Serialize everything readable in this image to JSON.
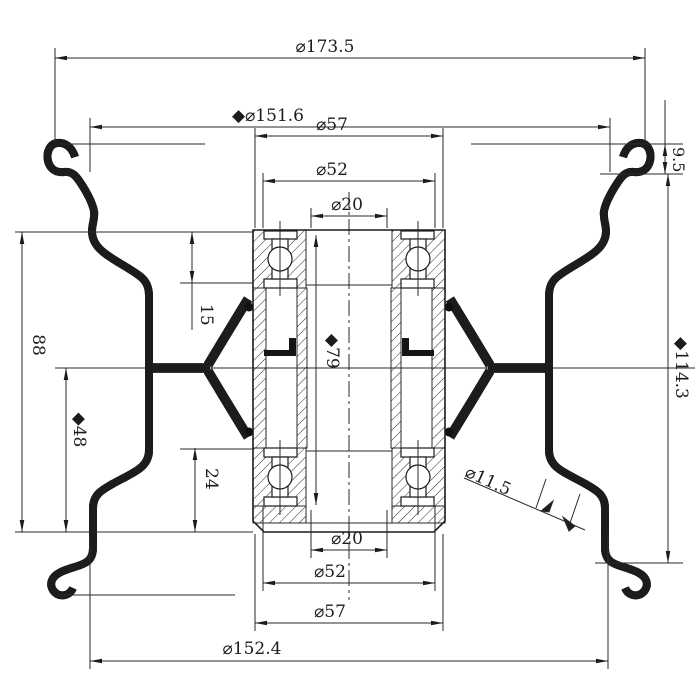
{
  "drawing": {
    "type": "engineering-cross-section",
    "subject": "wheel rim and hub full section view with bearings",
    "colors": {
      "line": "#2a2a2a",
      "background": "#ffffff"
    },
    "dims": {
      "d173_5": "⌀173.5",
      "d151_6": "◆⌀151.6",
      "d57_top": "⌀57",
      "d52_top": "⌀52",
      "d20_top": "⌀20",
      "d9_5": "9.5",
      "d114_3": "◆114.3",
      "d88": "88",
      "d48": "◆48",
      "d15": "15",
      "d24": "24",
      "d79": "◆79",
      "d11_5": "⌀11.5",
      "d20_bot": "⌀20",
      "d52_bot": "⌀52",
      "d57_bot": "⌀57",
      "d152_4": "⌀152.4"
    }
  }
}
